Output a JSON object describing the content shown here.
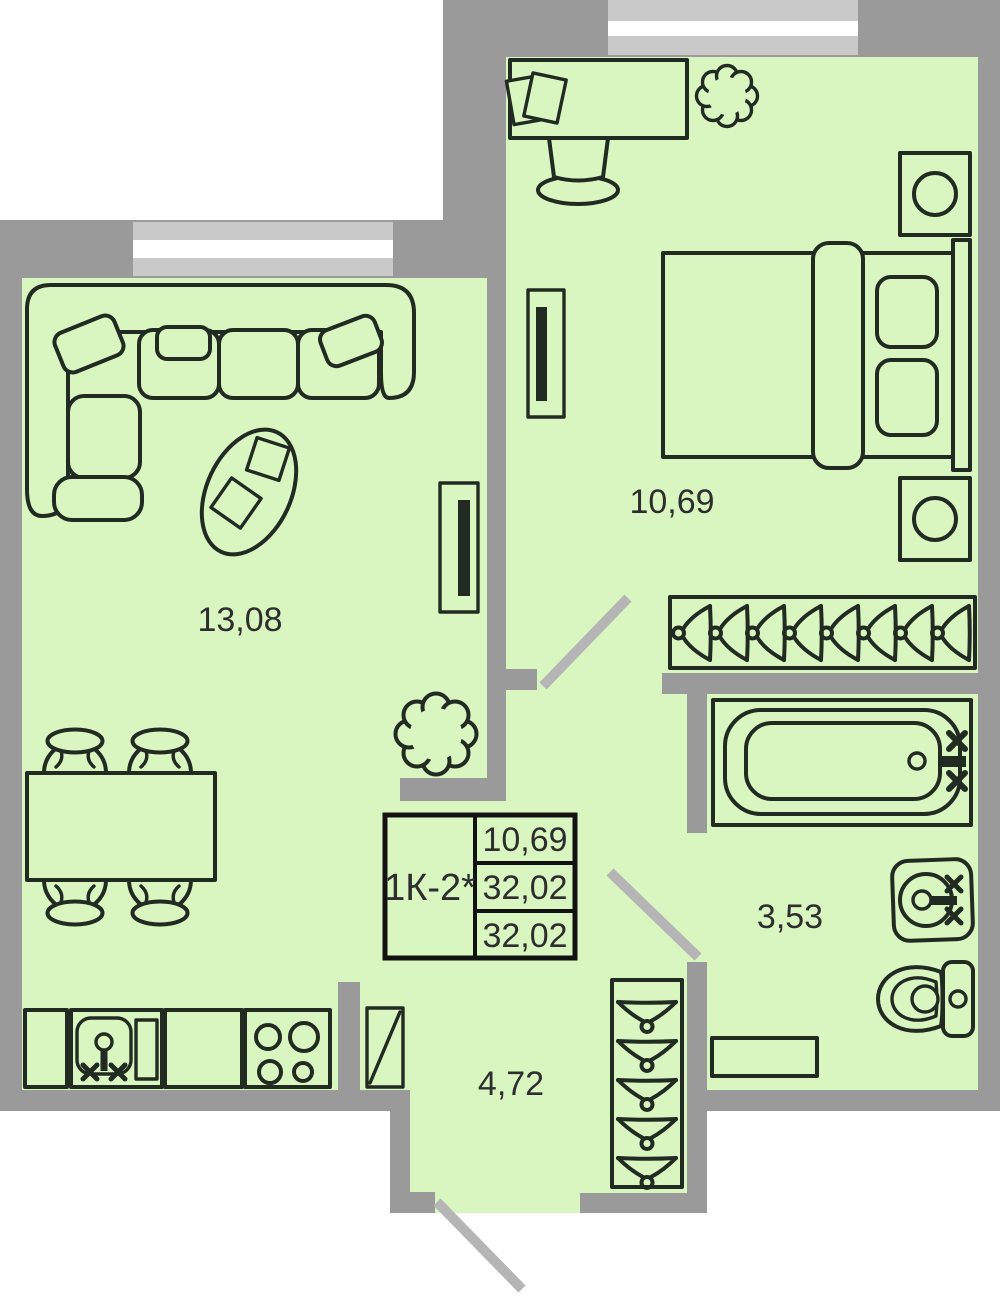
{
  "title": "Apartment floor plan",
  "info_card": {
    "unit_type": "1К-2*",
    "row1": "10,69",
    "row2": "32,02",
    "row3": "32,02"
  },
  "rooms": {
    "living_kitchen": {
      "name": "living-room-kitchen",
      "area": "13,08"
    },
    "bedroom": {
      "name": "bedroom",
      "area": "10,69"
    },
    "bathroom": {
      "name": "bathroom",
      "area": "3,53"
    },
    "hallway": {
      "name": "hallway",
      "area": "4,72"
    }
  },
  "furniture": {
    "living_kitchen": [
      "corner-sofa",
      "pillows",
      "coffee-table",
      "radiator",
      "plant",
      "dining-table",
      "four-chairs",
      "kitchen-cabinets",
      "kitchen-sink",
      "stove-4-burners",
      "door-leaf"
    ],
    "bedroom": [
      "desk",
      "papers",
      "desk-chair",
      "plant",
      "radiator",
      "double-bed",
      "two-pillows",
      "headboard",
      "nightstand-with-lamp-top",
      "nightstand-with-lamp-bottom",
      "wardrobe-8-hangers"
    ],
    "bathroom": [
      "bathtub",
      "faucet",
      "washbasin",
      "toilet",
      "shelf"
    ],
    "hallway": [
      "coat-rack-5-hangers"
    ]
  },
  "colors": {
    "background": "#ffffff",
    "floor": "#d9f6c1",
    "wall": "#9a9a9a",
    "window_frame": "#c9c9c9",
    "window_glass": "#ffffff",
    "door_swing": "#b5b5b5",
    "furniture_line": "#222b22",
    "table_border": "#121212",
    "text": "#2e2e2e"
  }
}
